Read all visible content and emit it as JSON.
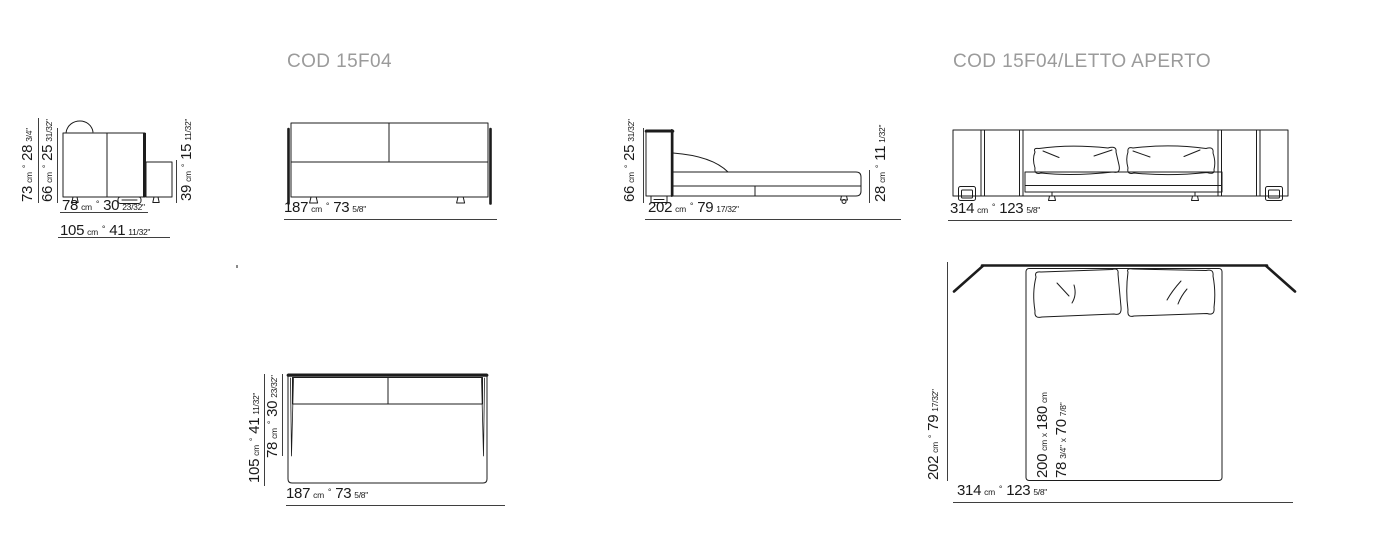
{
  "titles": {
    "closed": "COD 15F04",
    "open": "COD 15F04/LETTO APERTO"
  },
  "units": {
    "cm": "cm",
    "sep": "°"
  },
  "views": {
    "sofa_side": {
      "dims": {
        "height_total": {
          "cm": "73",
          "in": "28",
          "frac": "3/4\""
        },
        "height_seatback": {
          "cm": "66",
          "in": "25",
          "frac": "31/32\""
        },
        "height_extension": {
          "cm": "39",
          "in": "15",
          "frac": "11/32\""
        },
        "depth_seat": {
          "cm": "78",
          "in": "30",
          "frac": "23/32\""
        },
        "depth_total": {
          "cm": "105",
          "in": "41",
          "frac": "11/32\""
        }
      }
    },
    "sofa_front": {
      "dims": {
        "width": {
          "cm": "187",
          "in": "73",
          "frac": "5/8\""
        }
      }
    },
    "bed_side": {
      "dims": {
        "height_back": {
          "cm": "66",
          "in": "25",
          "frac": "31/32\""
        },
        "height_platform": {
          "cm": "28",
          "in": "11",
          "frac": "1/32\""
        },
        "length": {
          "cm": "202",
          "in": "79",
          "frac": "17/32\""
        }
      }
    },
    "bed_front": {
      "dims": {
        "width": {
          "cm": "314",
          "in": "123",
          "frac": "5/8\""
        }
      }
    },
    "sofa_top": {
      "dims": {
        "depth_total": {
          "cm": "105",
          "in": "41",
          "frac": "11/32\""
        },
        "depth_seat": {
          "cm": "78",
          "in": "30",
          "frac": "23/32\""
        },
        "width": {
          "cm": "187",
          "in": "73",
          "frac": "5/8\""
        }
      }
    },
    "bed_top": {
      "dims": {
        "depth": {
          "cm": "202",
          "in": "79",
          "frac": "17/32\""
        },
        "width": {
          "cm": "314",
          "in": "123",
          "frac": "5/8\""
        },
        "mattress_cm": {
          "v1": "200",
          "u1": "cm",
          "x": "x",
          "v2": "180",
          "u2": "cm"
        },
        "mattress_in": {
          "v1": "78",
          "f1": "3/4\"",
          "x": "x",
          "v2": "70",
          "f2": "7/8\""
        }
      }
    }
  },
  "colors": {
    "line": "#1c1c1c",
    "dim_line": "#3f3f3f",
    "title": "#9b9b9b",
    "text": "#1a1a1a"
  }
}
